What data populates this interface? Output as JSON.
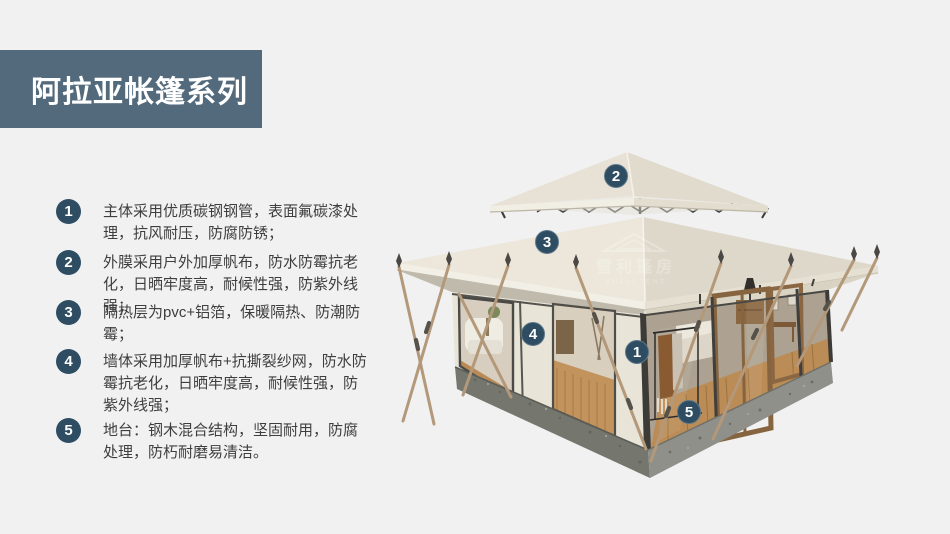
{
  "title": {
    "text": "阿拉亚帐篷系列"
  },
  "features": [
    {
      "num": "1",
      "text": "主体采用优质碳钢钢管，表面氟碳漆处理，抗风耐压，防腐防锈；"
    },
    {
      "num": "2",
      "text": "外膜采用户外加厚帆布，防水防霉抗老化，日晒牢度高，耐候性强，防紫外线强；"
    },
    {
      "num": "3",
      "text": "隔热层为pvc+铝箔，保暖隔热、防潮防霉；"
    },
    {
      "num": "4",
      "text": "墙体采用加厚帆布+抗撕裂纱网，防水防霉抗老化，日晒牢度高，耐候性强，防紫外线强；"
    },
    {
      "num": "5",
      "text": "地台：钢木混合结构，坚固耐用，防腐处理，防朽耐磨易清洁。"
    }
  ],
  "image": {
    "markers": [
      {
        "label": "1"
      },
      {
        "label": "2"
      },
      {
        "label": "3"
      },
      {
        "label": "4"
      },
      {
        "label": "5"
      }
    ],
    "watermark": {
      "cn": "雪利篷房",
      "en": "XUELI TENT"
    }
  },
  "colors": {
    "page_background": "#f1f1f2",
    "title_bg": "#536a7c",
    "accent_badge": "#2e4d62",
    "canvas_light": "#ece7da",
    "canvas_dark": "#ded8ca",
    "wood_pole": "#b3987a",
    "platform_gray": "#7e807a",
    "text": "#3e3e3e"
  }
}
